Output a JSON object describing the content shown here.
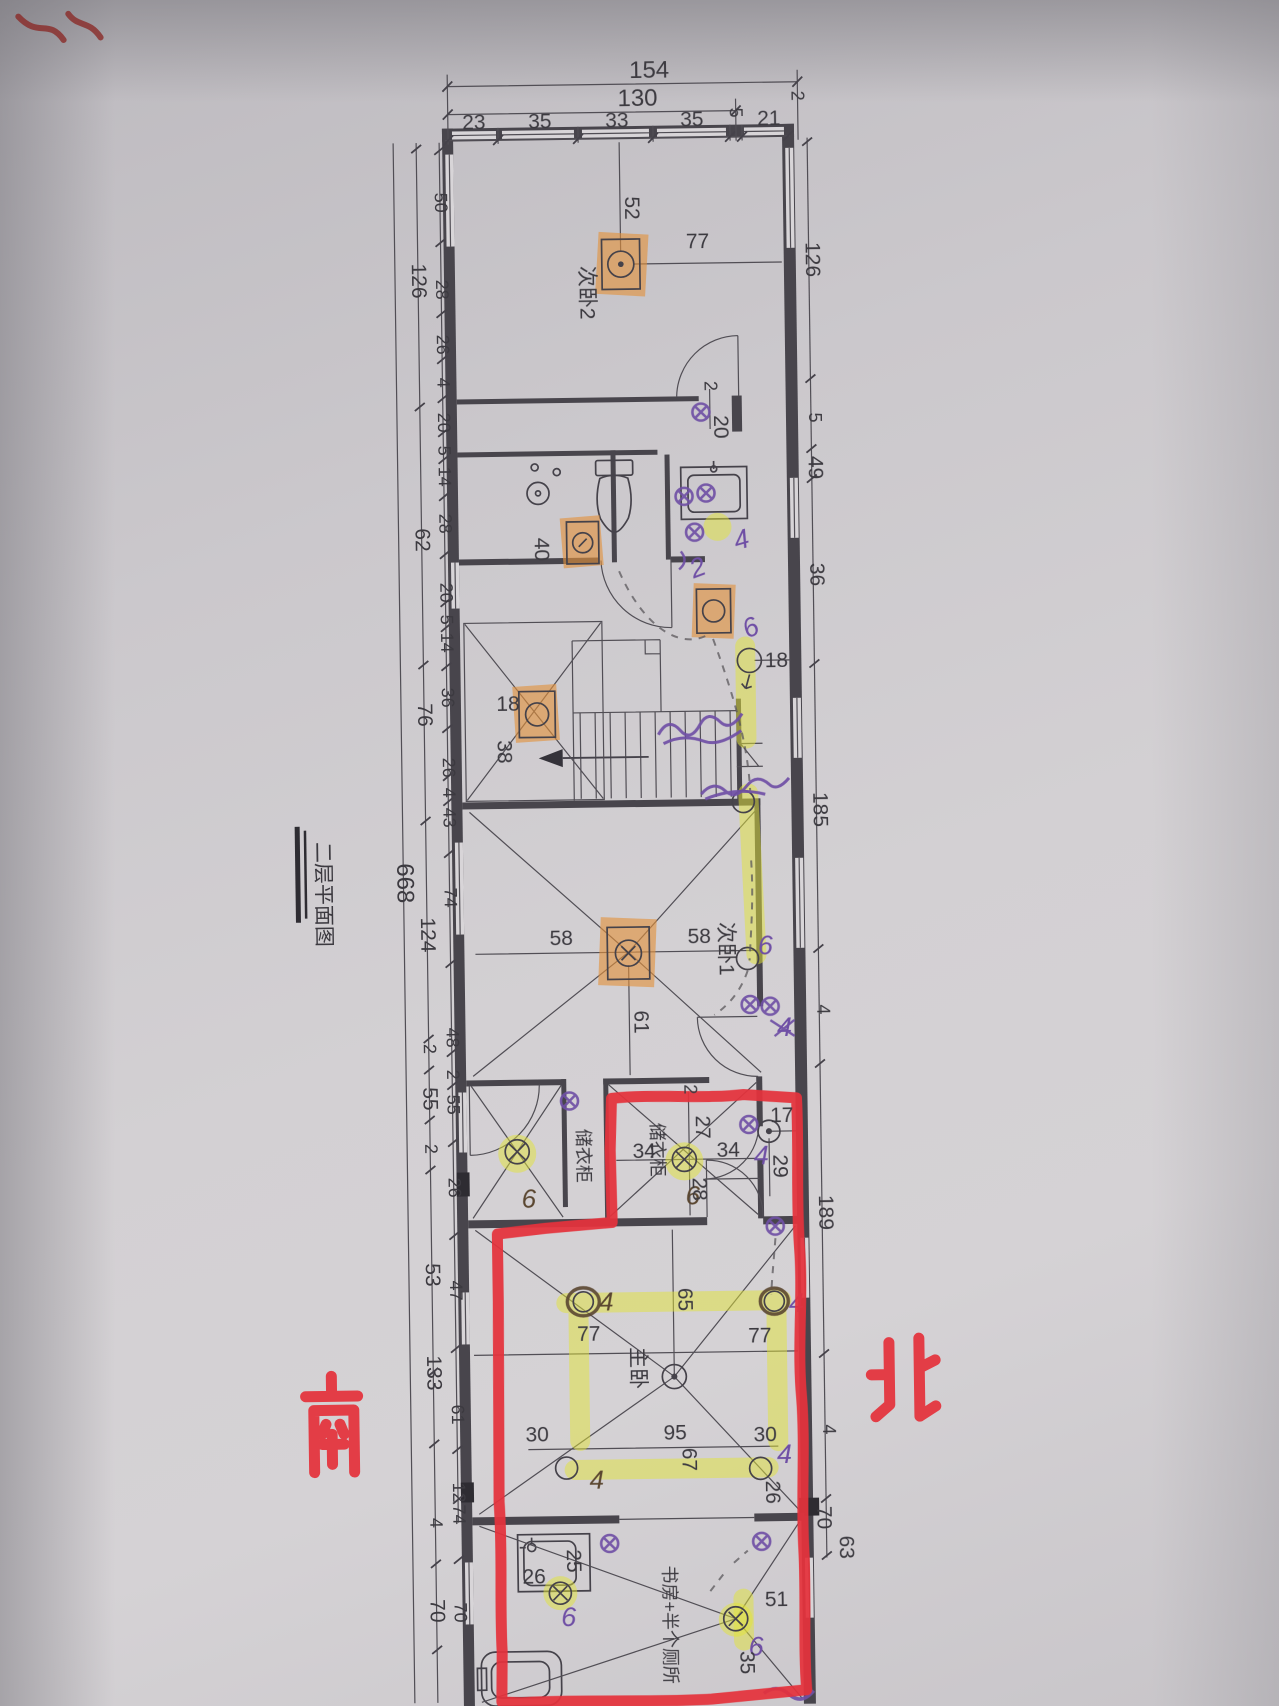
{
  "title_block": {
    "title": "二层平面图"
  },
  "compass": {
    "south": "南",
    "north": "北"
  },
  "rooms": {
    "bedroom2": "次卧2",
    "bedroom1": "次卧1",
    "wardrobe_left": "储衣柜",
    "wardrobe_right": "储衣柜",
    "master": "主卧",
    "study": "书房+半个厕所"
  },
  "dims_top": {
    "total": "154",
    "inner": "130",
    "segments": [
      "23",
      "35",
      "33",
      "35",
      "5",
      "21"
    ],
    "edge": "2"
  },
  "dims_left": {
    "overall": "668",
    "mid": [
      "126",
      "62",
      "76",
      "124",
      "2",
      "55",
      "2",
      "53",
      "133",
      "4",
      "70"
    ],
    "inner": [
      "50",
      "28",
      "26",
      "4",
      "20",
      "5",
      "14",
      "28",
      "20",
      "5",
      "14",
      "36",
      "26",
      "4",
      "43",
      "74",
      "48",
      "2",
      "55",
      "26",
      "47",
      "61",
      "12",
      "74",
      "70"
    ]
  },
  "dims_right": [
    "126",
    "5",
    "49",
    "36",
    "185",
    "4",
    "189",
    "4",
    "70",
    "63"
  ],
  "dims_interior": {
    "bed2_v": "52",
    "bed2_h": "77",
    "door_a": "2",
    "door_b": "20",
    "bath": "40",
    "hall_light": "18",
    "hall_v": "38",
    "corridor": "18",
    "bed1_left": "58",
    "bed1_right": "58",
    "bed1_v": "61",
    "ward_top": "2",
    "ward_v": "27",
    "ward_left": "34",
    "ward_right": "34",
    "ward_bottom": "28",
    "niche_h": "17",
    "niche_v": "29",
    "master_v": "65",
    "master_left": "77",
    "master_right": "77",
    "master_bl": "30",
    "master_bottom": "95",
    "master_bv": "67",
    "master_br": "30",
    "master_r": "26",
    "study_shower_w": "26",
    "study_shower_d": "25",
    "study_r": "51",
    "study_v": "35"
  },
  "handwriting": {
    "four": "4",
    "six": "6",
    "two": "2"
  },
  "colors": {
    "marker_red": "#e4323b",
    "highlight_yellow": "#e2e438",
    "highlight_orange": "#e2923c",
    "pen_purple": "#6f4fa5"
  }
}
